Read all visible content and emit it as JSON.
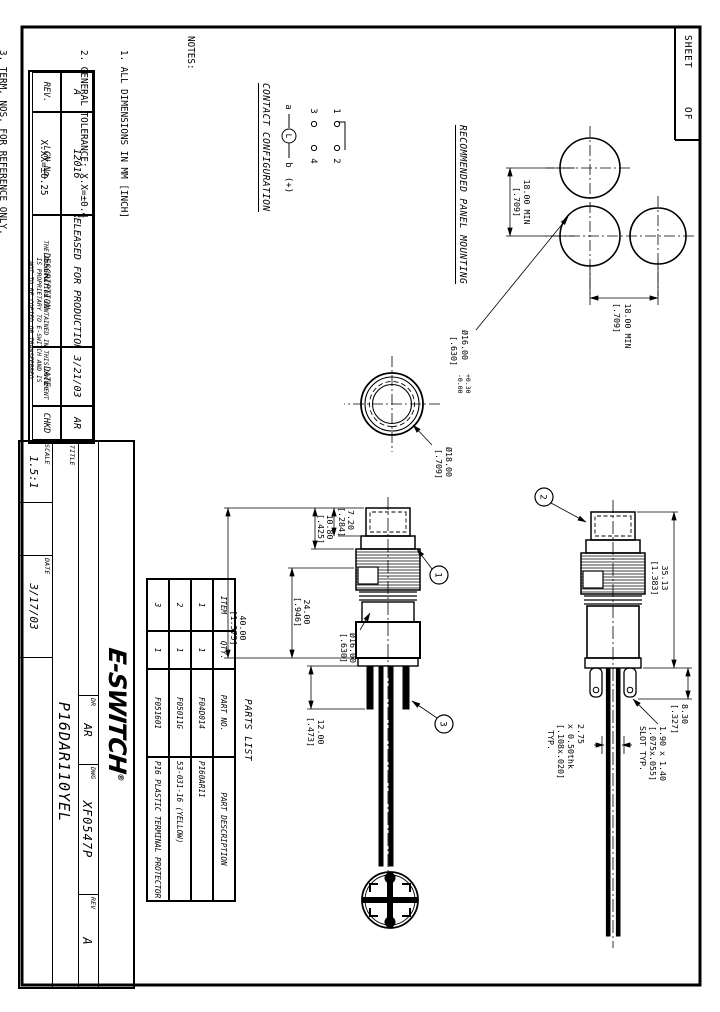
{
  "sheet_box": {
    "sheet_label": "SHEET",
    "of_label": "OF"
  },
  "notes": {
    "heading": "NOTES:",
    "lines": [
      "1. ALL DIMENSIONS IN MM [INCH]",
      "2. GENERAL TOLERANCE: X.X=±0.4",
      "                X.XX=±0.25",
      "3. TERM. NOS. FOR REFERENCE ONLY.",
      "4. RATING: 5A@250V AC / 5A@125V AC",
      "5. MECHANICAL LIFETIME: >2 MILLION OPERATIONS",
      "6. TRAVEL: 3.0MM",
      "7. CONTACT MATERIAL: COPPER ALLOY W/SILVER PLATING"
    ]
  },
  "contact_config": {
    "heading": "CONTACT CONFIGURATION",
    "t1": "1",
    "t2": "2",
    "t3": "3",
    "t4": "4",
    "ta": "a",
    "tb": "b",
    "lamp": "L",
    "plus": "(+)"
  },
  "panel_mounting": {
    "heading": "RECOMMENDED PANEL MOUNTING",
    "dim_h": {
      "v": "18.00 MIN",
      "i": "[.709]"
    },
    "dim_v": {
      "v": "18.00 MIN",
      "i": "[.709]"
    },
    "hole": {
      "d": "Ø16.00",
      "tol_plus": "+0.30",
      "tol_minus": "-0.00",
      "i": "[.630]"
    }
  },
  "front_view": {
    "dia": "Ø18.00",
    "dia_in": "[.709]"
  },
  "dims": {
    "sv1_cap": {
      "v": "7.20",
      "i": "[.284]"
    },
    "sv1_bezel": {
      "v": "10.80",
      "i": "[.425]"
    },
    "sv1_body": {
      "v": "24.00",
      "i": "[.946]"
    },
    "sv1_overall": {
      "v": "40.00",
      "i": "[1.575]"
    },
    "sv1_term": {
      "v": "12.00",
      "i": "[.473]"
    },
    "sv1_bushing": {
      "v": "Ø16.00",
      "i": "[.630]"
    },
    "sv2_overall": {
      "v": "35.13",
      "i": "[1.383]"
    },
    "sv2_term": {
      "v": "8.30",
      "i": "[.327]"
    },
    "slot_note": {
      "l1": "1.90 x 1.40",
      "l2": "[.075x.055]",
      "l3": "SLOT TYP."
    },
    "pin_note": {
      "l1": "2.75",
      "l2": "x 0.50thk",
      "l3": "[.108x.020]",
      "l4": "TYP."
    }
  },
  "balloons": {
    "b1": "1",
    "b2": "2",
    "b3": "3"
  },
  "parts_list": {
    "title": "PARTS LIST",
    "headers": [
      "ITEM",
      "QTY.",
      "PART NO.",
      "PART DESCRIPTION"
    ],
    "rows": [
      [
        "1",
        "1",
        "F04D014",
        "P160AR11"
      ],
      [
        "2",
        "1",
        "F05011G",
        "53-031-16 (YELLOW)"
      ],
      [
        "3",
        "1",
        "F051601",
        "P16 PLASTIC TERMINAL PROTECTOR"
      ]
    ]
  },
  "rev_table": {
    "headers": [
      "REV.",
      "LCN No.",
      "DESCRIPTION",
      "DATE",
      "CHKD"
    ],
    "row": [
      "A",
      "12016",
      "RELEASED FOR PRODUCTION",
      "3/21/03",
      "AR"
    ]
  },
  "proprietary": {
    "l1": "THE INFORMATION CONTAINED IN THIS DOCUMENT",
    "l2": "IS PROPRIETARY TO E-SWITCH AND IS",
    "l3": "NOT TO BE COPIED OR TRANSFERRED"
  },
  "title_block": {
    "logo": "E-SWITCH",
    "reg": "®",
    "title_label": "TITLE",
    "title": "P16DAR110YEL",
    "scale_label": "SCALE",
    "scale": "1.5:1",
    "date_label": "DATE",
    "date": "3/17/03",
    "dr_label": "DR",
    "dr": "AR",
    "dwg_label": "DWG",
    "dwg": "XF0547P",
    "rev_label": "REV",
    "rev": "A"
  }
}
